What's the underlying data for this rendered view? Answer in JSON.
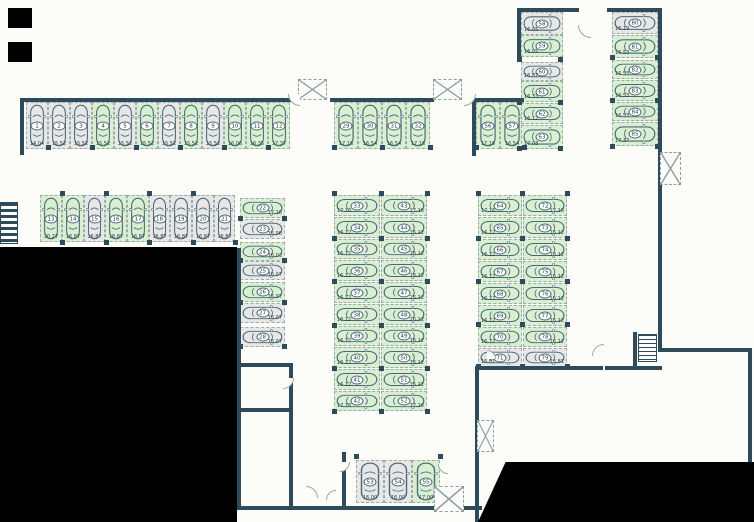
{
  "plan_title": "parking-garage-floor-plan",
  "colors": {
    "free_space": "#d9efd2",
    "occupied_space": "#e7e7e7",
    "wall": "#2e4b5c",
    "car_outline": "#4a6875"
  },
  "spaces": [
    {
      "id": "1",
      "area": "14.04",
      "status": "occupied",
      "x": 26,
      "y": 102,
      "w": 22,
      "h": 47,
      "o": "v",
      "vp": "b"
    },
    {
      "id": "2",
      "area": "15.52",
      "status": "occupied",
      "x": 48,
      "y": 102,
      "w": 22,
      "h": 47,
      "o": "v",
      "vp": "b"
    },
    {
      "id": "3",
      "area": "15.52",
      "status": "occupied",
      "x": 70,
      "y": 102,
      "w": 22,
      "h": 47,
      "o": "v",
      "vp": "b"
    },
    {
      "id": "4",
      "area": "15.52",
      "status": "free",
      "x": 92,
      "y": 102,
      "w": 22,
      "h": 47,
      "o": "v",
      "vp": "b"
    },
    {
      "id": "5",
      "area": "15.52",
      "status": "occupied",
      "x": 114,
      "y": 102,
      "w": 22,
      "h": 47,
      "o": "v",
      "vp": "b"
    },
    {
      "id": "6",
      "area": "15.52",
      "status": "free",
      "x": 136,
      "y": 102,
      "w": 22,
      "h": 47,
      "o": "v",
      "vp": "b"
    },
    {
      "id": "7",
      "area": "15.52",
      "status": "occupied",
      "x": 158,
      "y": 102,
      "w": 22,
      "h": 47,
      "o": "v",
      "vp": "b"
    },
    {
      "id": "8",
      "area": "15.52",
      "status": "free",
      "x": 180,
      "y": 102,
      "w": 22,
      "h": 47,
      "o": "v",
      "vp": "b"
    },
    {
      "id": "9",
      "area": "15.52",
      "status": "occupied",
      "x": 202,
      "y": 102,
      "w": 22,
      "h": 47,
      "o": "v",
      "vp": "b"
    },
    {
      "id": "10",
      "area": "16.06",
      "status": "free",
      "x": 224,
      "y": 102,
      "w": 22,
      "h": 47,
      "o": "v",
      "vp": "b"
    },
    {
      "id": "11",
      "area": "16.35",
      "status": "free",
      "x": 246,
      "y": 102,
      "w": 22,
      "h": 47,
      "o": "v",
      "vp": "b"
    },
    {
      "id": "12",
      "area": "17.37",
      "status": "free",
      "x": 268,
      "y": 102,
      "w": 22,
      "h": 47,
      "o": "v",
      "vp": "b"
    },
    {
      "id": "13",
      "area": "20.27",
      "status": "free",
      "x": 40,
      "y": 195,
      "w": 22,
      "h": 47,
      "o": "v",
      "vp": "b"
    },
    {
      "id": "14",
      "area": "16.87",
      "status": "free",
      "x": 62,
      "y": 195,
      "w": 22,
      "h": 47,
      "o": "v",
      "vp": "b"
    },
    {
      "id": "15",
      "area": "16.87",
      "status": "occupied",
      "x": 84,
      "y": 195,
      "w": 21,
      "h": 47,
      "o": "v",
      "vp": "b"
    },
    {
      "id": "16",
      "area": "16.87",
      "status": "free",
      "x": 105,
      "y": 195,
      "w": 22,
      "h": 47,
      "o": "v",
      "vp": "b"
    },
    {
      "id": "17",
      "area": "16.87",
      "status": "free",
      "x": 127,
      "y": 195,
      "w": 22,
      "h": 47,
      "o": "v",
      "vp": "b"
    },
    {
      "id": "18",
      "area": "16.87",
      "status": "occupied",
      "x": 149,
      "y": 195,
      "w": 21,
      "h": 47,
      "o": "v",
      "vp": "b"
    },
    {
      "id": "19",
      "area": "16.87",
      "status": "occupied",
      "x": 170,
      "y": 195,
      "w": 22,
      "h": 47,
      "o": "v",
      "vp": "b"
    },
    {
      "id": "20",
      "area": "16.87",
      "status": "occupied",
      "x": 192,
      "y": 195,
      "w": 22,
      "h": 47,
      "o": "v",
      "vp": "b"
    },
    {
      "id": "21",
      "area": "16.87",
      "status": "occupied",
      "x": 214,
      "y": 195,
      "w": 21,
      "h": 47,
      "o": "v",
      "vp": "b"
    },
    {
      "id": "22",
      "area": "17.16",
      "status": "free",
      "x": 240,
      "y": 198,
      "w": 45,
      "h": 20,
      "o": "h",
      "vp": "br"
    },
    {
      "id": "23",
      "area": "16.00",
      "status": "occupied",
      "x": 240,
      "y": 219,
      "w": 45,
      "h": 20,
      "o": "h",
      "vp": "br"
    },
    {
      "id": "24",
      "area": "16.03",
      "status": "free",
      "x": 240,
      "y": 242,
      "w": 45,
      "h": 19,
      "o": "h",
      "vp": "br"
    },
    {
      "id": "25",
      "area": "16.07",
      "status": "occupied",
      "x": 240,
      "y": 261,
      "w": 45,
      "h": 19,
      "o": "h",
      "vp": "br"
    },
    {
      "id": "26",
      "area": "16.07",
      "status": "free",
      "x": 240,
      "y": 282,
      "w": 45,
      "h": 20,
      "o": "h",
      "vp": "br"
    },
    {
      "id": "27",
      "area": "16.07",
      "status": "occupied",
      "x": 240,
      "y": 303,
      "w": 45,
      "h": 20,
      "o": "h",
      "vp": "br"
    },
    {
      "id": "28",
      "area": "16.07",
      "status": "occupied",
      "x": 240,
      "y": 327,
      "w": 45,
      "h": 20,
      "o": "h",
      "vp": "br"
    },
    {
      "id": "29",
      "area": "17.16",
      "status": "free",
      "x": 334,
      "y": 102,
      "w": 24,
      "h": 47,
      "o": "v",
      "vp": "b"
    },
    {
      "id": "30",
      "area": "16.54",
      "status": "free",
      "x": 358,
      "y": 102,
      "w": 24,
      "h": 47,
      "o": "v",
      "vp": "b"
    },
    {
      "id": "31",
      "area": "16.54",
      "status": "free",
      "x": 382,
      "y": 102,
      "w": 24,
      "h": 47,
      "o": "v",
      "vp": "b"
    },
    {
      "id": "32",
      "area": "17.16",
      "status": "free",
      "x": 406,
      "y": 102,
      "w": 24,
      "h": 47,
      "o": "v",
      "vp": "b"
    },
    {
      "id": "33",
      "area": "17.16",
      "status": "free",
      "x": 334,
      "y": 195,
      "w": 46,
      "h": 21,
      "o": "h",
      "vp": "bl"
    },
    {
      "id": "34",
      "area": "16.12",
      "status": "free",
      "x": 334,
      "y": 217,
      "w": 46,
      "h": 21,
      "o": "h",
      "vp": "bl"
    },
    {
      "id": "35",
      "area": "16.12",
      "status": "free",
      "x": 334,
      "y": 239,
      "w": 46,
      "h": 20,
      "o": "h",
      "vp": "bl"
    },
    {
      "id": "36",
      "area": "16.12",
      "status": "free",
      "x": 334,
      "y": 260,
      "w": 46,
      "h": 21,
      "o": "h",
      "vp": "bl"
    },
    {
      "id": "37",
      "area": "16.12",
      "status": "free",
      "x": 334,
      "y": 282,
      "w": 46,
      "h": 21,
      "o": "h",
      "vp": "bl"
    },
    {
      "id": "38",
      "area": "16.12",
      "status": "free",
      "x": 334,
      "y": 304,
      "w": 46,
      "h": 21,
      "o": "h",
      "vp": "bl"
    },
    {
      "id": "39",
      "area": "16.12",
      "status": "free",
      "x": 334,
      "y": 326,
      "w": 46,
      "h": 20,
      "o": "h",
      "vp": "bl"
    },
    {
      "id": "40",
      "area": "16.12",
      "status": "free",
      "x": 334,
      "y": 347,
      "w": 46,
      "h": 21,
      "o": "h",
      "vp": "bl"
    },
    {
      "id": "41",
      "area": "16.12",
      "status": "free",
      "x": 334,
      "y": 369,
      "w": 46,
      "h": 21,
      "o": "h",
      "vp": "bl"
    },
    {
      "id": "42",
      "area": "17.16",
      "status": "free",
      "x": 334,
      "y": 391,
      "w": 46,
      "h": 20,
      "o": "h",
      "vp": "bl"
    },
    {
      "id": "43",
      "area": "17.16",
      "status": "free",
      "x": 381,
      "y": 195,
      "w": 46,
      "h": 21,
      "o": "h",
      "vp": "br"
    },
    {
      "id": "44",
      "area": "16.12",
      "status": "free",
      "x": 381,
      "y": 217,
      "w": 46,
      "h": 21,
      "o": "h",
      "vp": "br"
    },
    {
      "id": "45",
      "area": "16.12",
      "status": "free",
      "x": 381,
      "y": 239,
      "w": 46,
      "h": 20,
      "o": "h",
      "vp": "br"
    },
    {
      "id": "46",
      "area": "16.12",
      "status": "free",
      "x": 381,
      "y": 260,
      "w": 46,
      "h": 21,
      "o": "h",
      "vp": "br"
    },
    {
      "id": "47",
      "area": "16.12",
      "status": "free",
      "x": 381,
      "y": 282,
      "w": 46,
      "h": 21,
      "o": "h",
      "vp": "br"
    },
    {
      "id": "48",
      "area": "16.12",
      "status": "free",
      "x": 381,
      "y": 304,
      "w": 46,
      "h": 21,
      "o": "h",
      "vp": "br"
    },
    {
      "id": "49",
      "area": "16.12",
      "status": "free",
      "x": 381,
      "y": 326,
      "w": 46,
      "h": 20,
      "o": "h",
      "vp": "br"
    },
    {
      "id": "50",
      "area": "16.12",
      "status": "free",
      "x": 381,
      "y": 347,
      "w": 46,
      "h": 21,
      "o": "h",
      "vp": "br"
    },
    {
      "id": "51",
      "area": "16.12",
      "status": "free",
      "x": 381,
      "y": 369,
      "w": 46,
      "h": 21,
      "o": "h",
      "vp": "br"
    },
    {
      "id": "52",
      "area": "17.16",
      "status": "free",
      "x": 381,
      "y": 391,
      "w": 46,
      "h": 20,
      "o": "h",
      "vp": "br"
    },
    {
      "id": "53",
      "area": "16.00",
      "status": "occupied",
      "x": 356,
      "y": 460,
      "w": 28,
      "h": 43,
      "o": "v",
      "vp": "b"
    },
    {
      "id": "54",
      "area": "16.00",
      "status": "occupied",
      "x": 384,
      "y": 460,
      "w": 28,
      "h": 43,
      "o": "v",
      "vp": "b"
    },
    {
      "id": "55",
      "area": "17.00",
      "status": "free",
      "x": 412,
      "y": 460,
      "w": 28,
      "h": 43,
      "o": "v",
      "vp": "b"
    },
    {
      "id": "56",
      "area": "17.16",
      "status": "free",
      "x": 476,
      "y": 102,
      "w": 24,
      "h": 47,
      "o": "v",
      "vp": "b"
    },
    {
      "id": "57",
      "area": "16.54",
      "status": "free",
      "x": 500,
      "y": 102,
      "w": 24,
      "h": 47,
      "o": "v",
      "vp": "b"
    },
    {
      "id": "58",
      "area": "16.05",
      "status": "occupied",
      "x": 521,
      "y": 12,
      "w": 42,
      "h": 23,
      "o": "h",
      "vp": "bl"
    },
    {
      "id": "59",
      "area": "16.05",
      "status": "free",
      "x": 521,
      "y": 35,
      "w": 42,
      "h": 22,
      "o": "h",
      "vp": "bl"
    },
    {
      "id": "60",
      "area": "16.07",
      "status": "occupied",
      "x": 521,
      "y": 62,
      "w": 42,
      "h": 19,
      "o": "h",
      "vp": "bl"
    },
    {
      "id": "61",
      "area": "16.33",
      "status": "free",
      "x": 521,
      "y": 81,
      "w": 42,
      "h": 21,
      "o": "h",
      "vp": "bl"
    },
    {
      "id": "62",
      "area": "16.12",
      "status": "free",
      "x": 521,
      "y": 103,
      "w": 42,
      "h": 21,
      "o": "h",
      "vp": "bl"
    },
    {
      "id": "63",
      "area": "17.08",
      "status": "free",
      "x": 521,
      "y": 125,
      "w": 42,
      "h": 24,
      "o": "h",
      "vp": "bl"
    },
    {
      "id": "64",
      "area": "17.16",
      "status": "free",
      "x": 478,
      "y": 195,
      "w": 44,
      "h": 21,
      "o": "h",
      "vp": "bl"
    },
    {
      "id": "65",
      "area": "16.12",
      "status": "free",
      "x": 478,
      "y": 217,
      "w": 44,
      "h": 21,
      "o": "h",
      "vp": "bl"
    },
    {
      "id": "66",
      "area": "16.12",
      "status": "free",
      "x": 478,
      "y": 239,
      "w": 44,
      "h": 21,
      "o": "h",
      "vp": "bl"
    },
    {
      "id": "67",
      "area": "16.12",
      "status": "free",
      "x": 478,
      "y": 261,
      "w": 44,
      "h": 21,
      "o": "h",
      "vp": "bl"
    },
    {
      "id": "68",
      "area": "16.12",
      "status": "free",
      "x": 478,
      "y": 283,
      "w": 44,
      "h": 21,
      "o": "h",
      "vp": "bl"
    },
    {
      "id": "69",
      "area": "16.12",
      "status": "free",
      "x": 478,
      "y": 305,
      "w": 44,
      "h": 21,
      "o": "h",
      "vp": "bl"
    },
    {
      "id": "70",
      "area": "16.12",
      "status": "free",
      "x": 478,
      "y": 327,
      "w": 44,
      "h": 20,
      "o": "h",
      "vp": "bl"
    },
    {
      "id": "71",
      "area": "15.81",
      "status": "occupied",
      "x": 478,
      "y": 348,
      "w": 44,
      "h": 19,
      "o": "h",
      "vp": "bl"
    },
    {
      "id": "72",
      "area": "17.16",
      "status": "free",
      "x": 523,
      "y": 195,
      "w": 44,
      "h": 21,
      "o": "h",
      "vp": "br"
    },
    {
      "id": "73",
      "area": "16.12",
      "status": "free",
      "x": 523,
      "y": 217,
      "w": 44,
      "h": 21,
      "o": "h",
      "vp": "br"
    },
    {
      "id": "74",
      "area": "16.12",
      "status": "free",
      "x": 523,
      "y": 239,
      "w": 44,
      "h": 21,
      "o": "h",
      "vp": "br"
    },
    {
      "id": "75",
      "area": "16.12",
      "status": "free",
      "x": 523,
      "y": 261,
      "w": 44,
      "h": 21,
      "o": "h",
      "vp": "br"
    },
    {
      "id": "76",
      "area": "16.12",
      "status": "free",
      "x": 523,
      "y": 283,
      "w": 44,
      "h": 21,
      "o": "h",
      "vp": "br"
    },
    {
      "id": "77",
      "area": "16.12",
      "status": "free",
      "x": 523,
      "y": 305,
      "w": 44,
      "h": 21,
      "o": "h",
      "vp": "br"
    },
    {
      "id": "78",
      "area": "16.12",
      "status": "free",
      "x": 523,
      "y": 327,
      "w": 44,
      "h": 20,
      "o": "h",
      "vp": "br"
    },
    {
      "id": "79",
      "area": "15.81",
      "status": "occupied",
      "x": 523,
      "y": 348,
      "w": 44,
      "h": 19,
      "o": "h",
      "vp": "br"
    },
    {
      "id": "80",
      "area": "16.19",
      "status": "occupied",
      "x": 612,
      "y": 12,
      "w": 46,
      "h": 22,
      "o": "h",
      "vp": "bl"
    },
    {
      "id": "81",
      "area": "16.53",
      "status": "free",
      "x": 612,
      "y": 35,
      "w": 46,
      "h": 23,
      "o": "h",
      "vp": "bl"
    },
    {
      "id": "82",
      "area": "16.53",
      "status": "free",
      "x": 612,
      "y": 60,
      "w": 46,
      "h": 19,
      "o": "h",
      "vp": "bl"
    },
    {
      "id": "83",
      "area": "16.53",
      "status": "free",
      "x": 612,
      "y": 80,
      "w": 46,
      "h": 21,
      "o": "h",
      "vp": "bl"
    },
    {
      "id": "84",
      "area": "16.53",
      "status": "free",
      "x": 612,
      "y": 102,
      "w": 46,
      "h": 19,
      "o": "h",
      "vp": "bl"
    },
    {
      "id": "85",
      "area": "17.37",
      "status": "free",
      "x": 612,
      "y": 122,
      "w": 46,
      "h": 24,
      "o": "h",
      "vp": "bl"
    }
  ]
}
